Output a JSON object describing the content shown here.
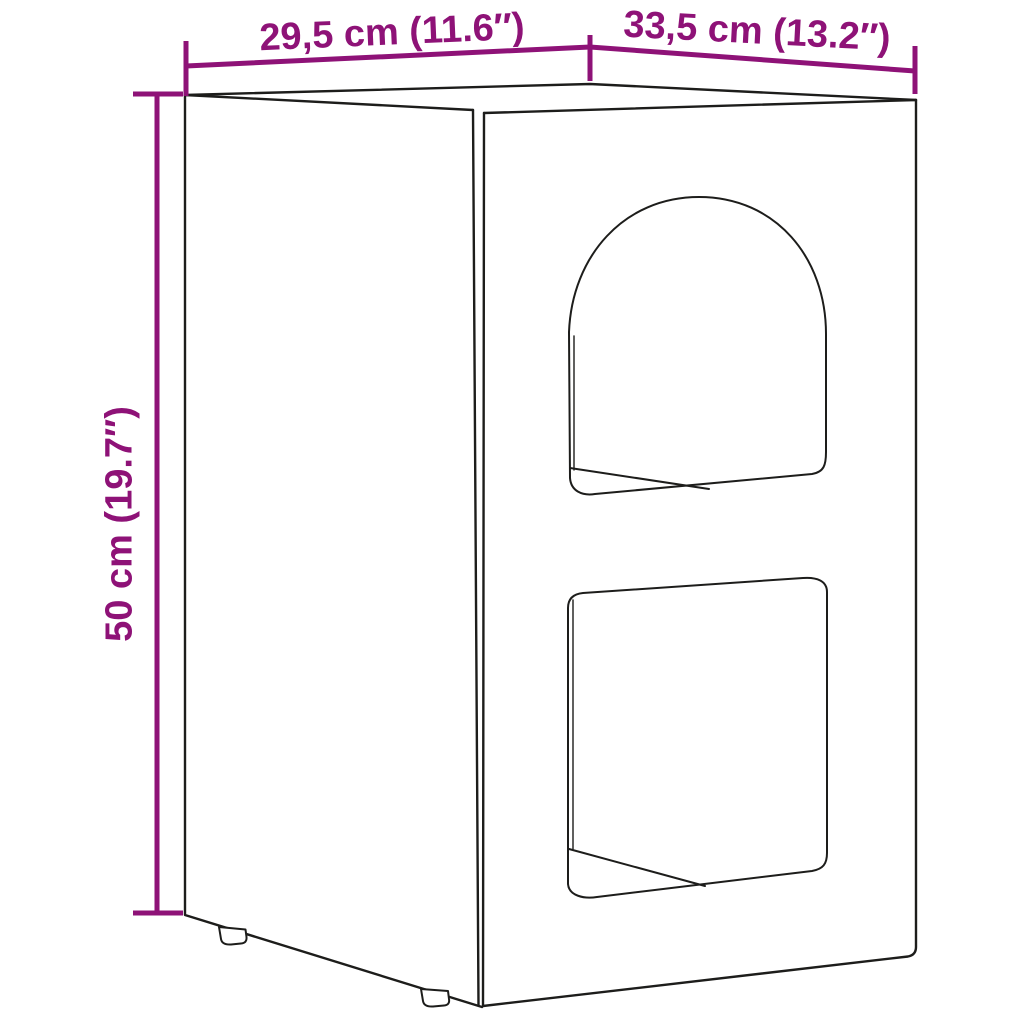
{
  "dimensions": {
    "depth": "29,5 cm (11.6″)",
    "width": "33,5 cm (13.2″)",
    "height": "50 cm (19.7″)"
  },
  "colors": {
    "accent": "#8E1277",
    "line": "#1D1D1B",
    "background": "#FFFFFF"
  }
}
